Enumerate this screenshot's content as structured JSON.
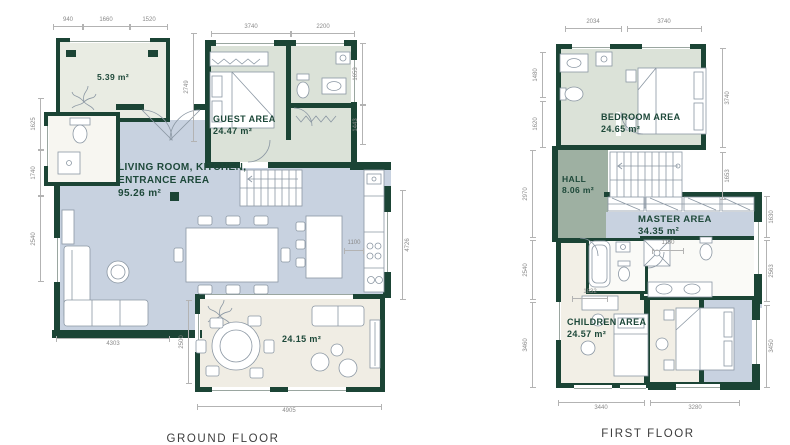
{
  "ground_floor": {
    "title": "GROUND FLOOR",
    "rooms": [
      {
        "name": "storage",
        "label": "",
        "area": "5.39 m²"
      },
      {
        "name": "guest",
        "label": "GUEST AREA",
        "area": "24.47 m²"
      },
      {
        "name": "living",
        "label": "LIVING ROOM, KITCHEN, ENTRANCE AREA",
        "area": "95.26 m²"
      },
      {
        "name": "terrace",
        "label": "",
        "area": "24.15 m²"
      }
    ],
    "dims": {
      "t1": "940",
      "t2": "1660",
      "t3": "1520",
      "t4": "3740",
      "t5": "2200",
      "mid": "2749",
      "r1": "1653",
      "r2": "1443",
      "r3": "4726",
      "l1": "1625",
      "l2": "1740",
      "l3": "2540",
      "b1": "4303",
      "b2": "2500",
      "b3": "4905",
      "k1": "1100"
    }
  },
  "first_floor": {
    "title": "FIRST FLOOR",
    "rooms": [
      {
        "name": "bedroom",
        "label": "BEDROOM AREA",
        "area": "24.65 m²"
      },
      {
        "name": "hall",
        "label": "HALL",
        "area": "8.06 m²"
      },
      {
        "name": "master",
        "label": "MASTER AREA",
        "area": "34.35 m²"
      },
      {
        "name": "children",
        "label": "CHILDREN AREA",
        "area": "24.57 m²"
      }
    ],
    "dims": {
      "t1": "2034",
      "t2": "3740",
      "l1": "1480",
      "l2": "1620",
      "l3": "2970",
      "l4": "2540",
      "l5": "3460",
      "r1": "3740",
      "r2": "1653",
      "r3": "1630",
      "r4": "2563",
      "r5": "3450",
      "b1": "3440",
      "b2": "3280",
      "i1": "1180",
      "i2": "1832"
    }
  },
  "colors": {
    "wall": "#1b4435",
    "living_floor": "#c8d2e0",
    "bedroom_floor": "#dbe2d8",
    "hall_floor": "#9eb0a2",
    "terrace_floor": "#f0ede4",
    "label_text": "#1d4839"
  }
}
